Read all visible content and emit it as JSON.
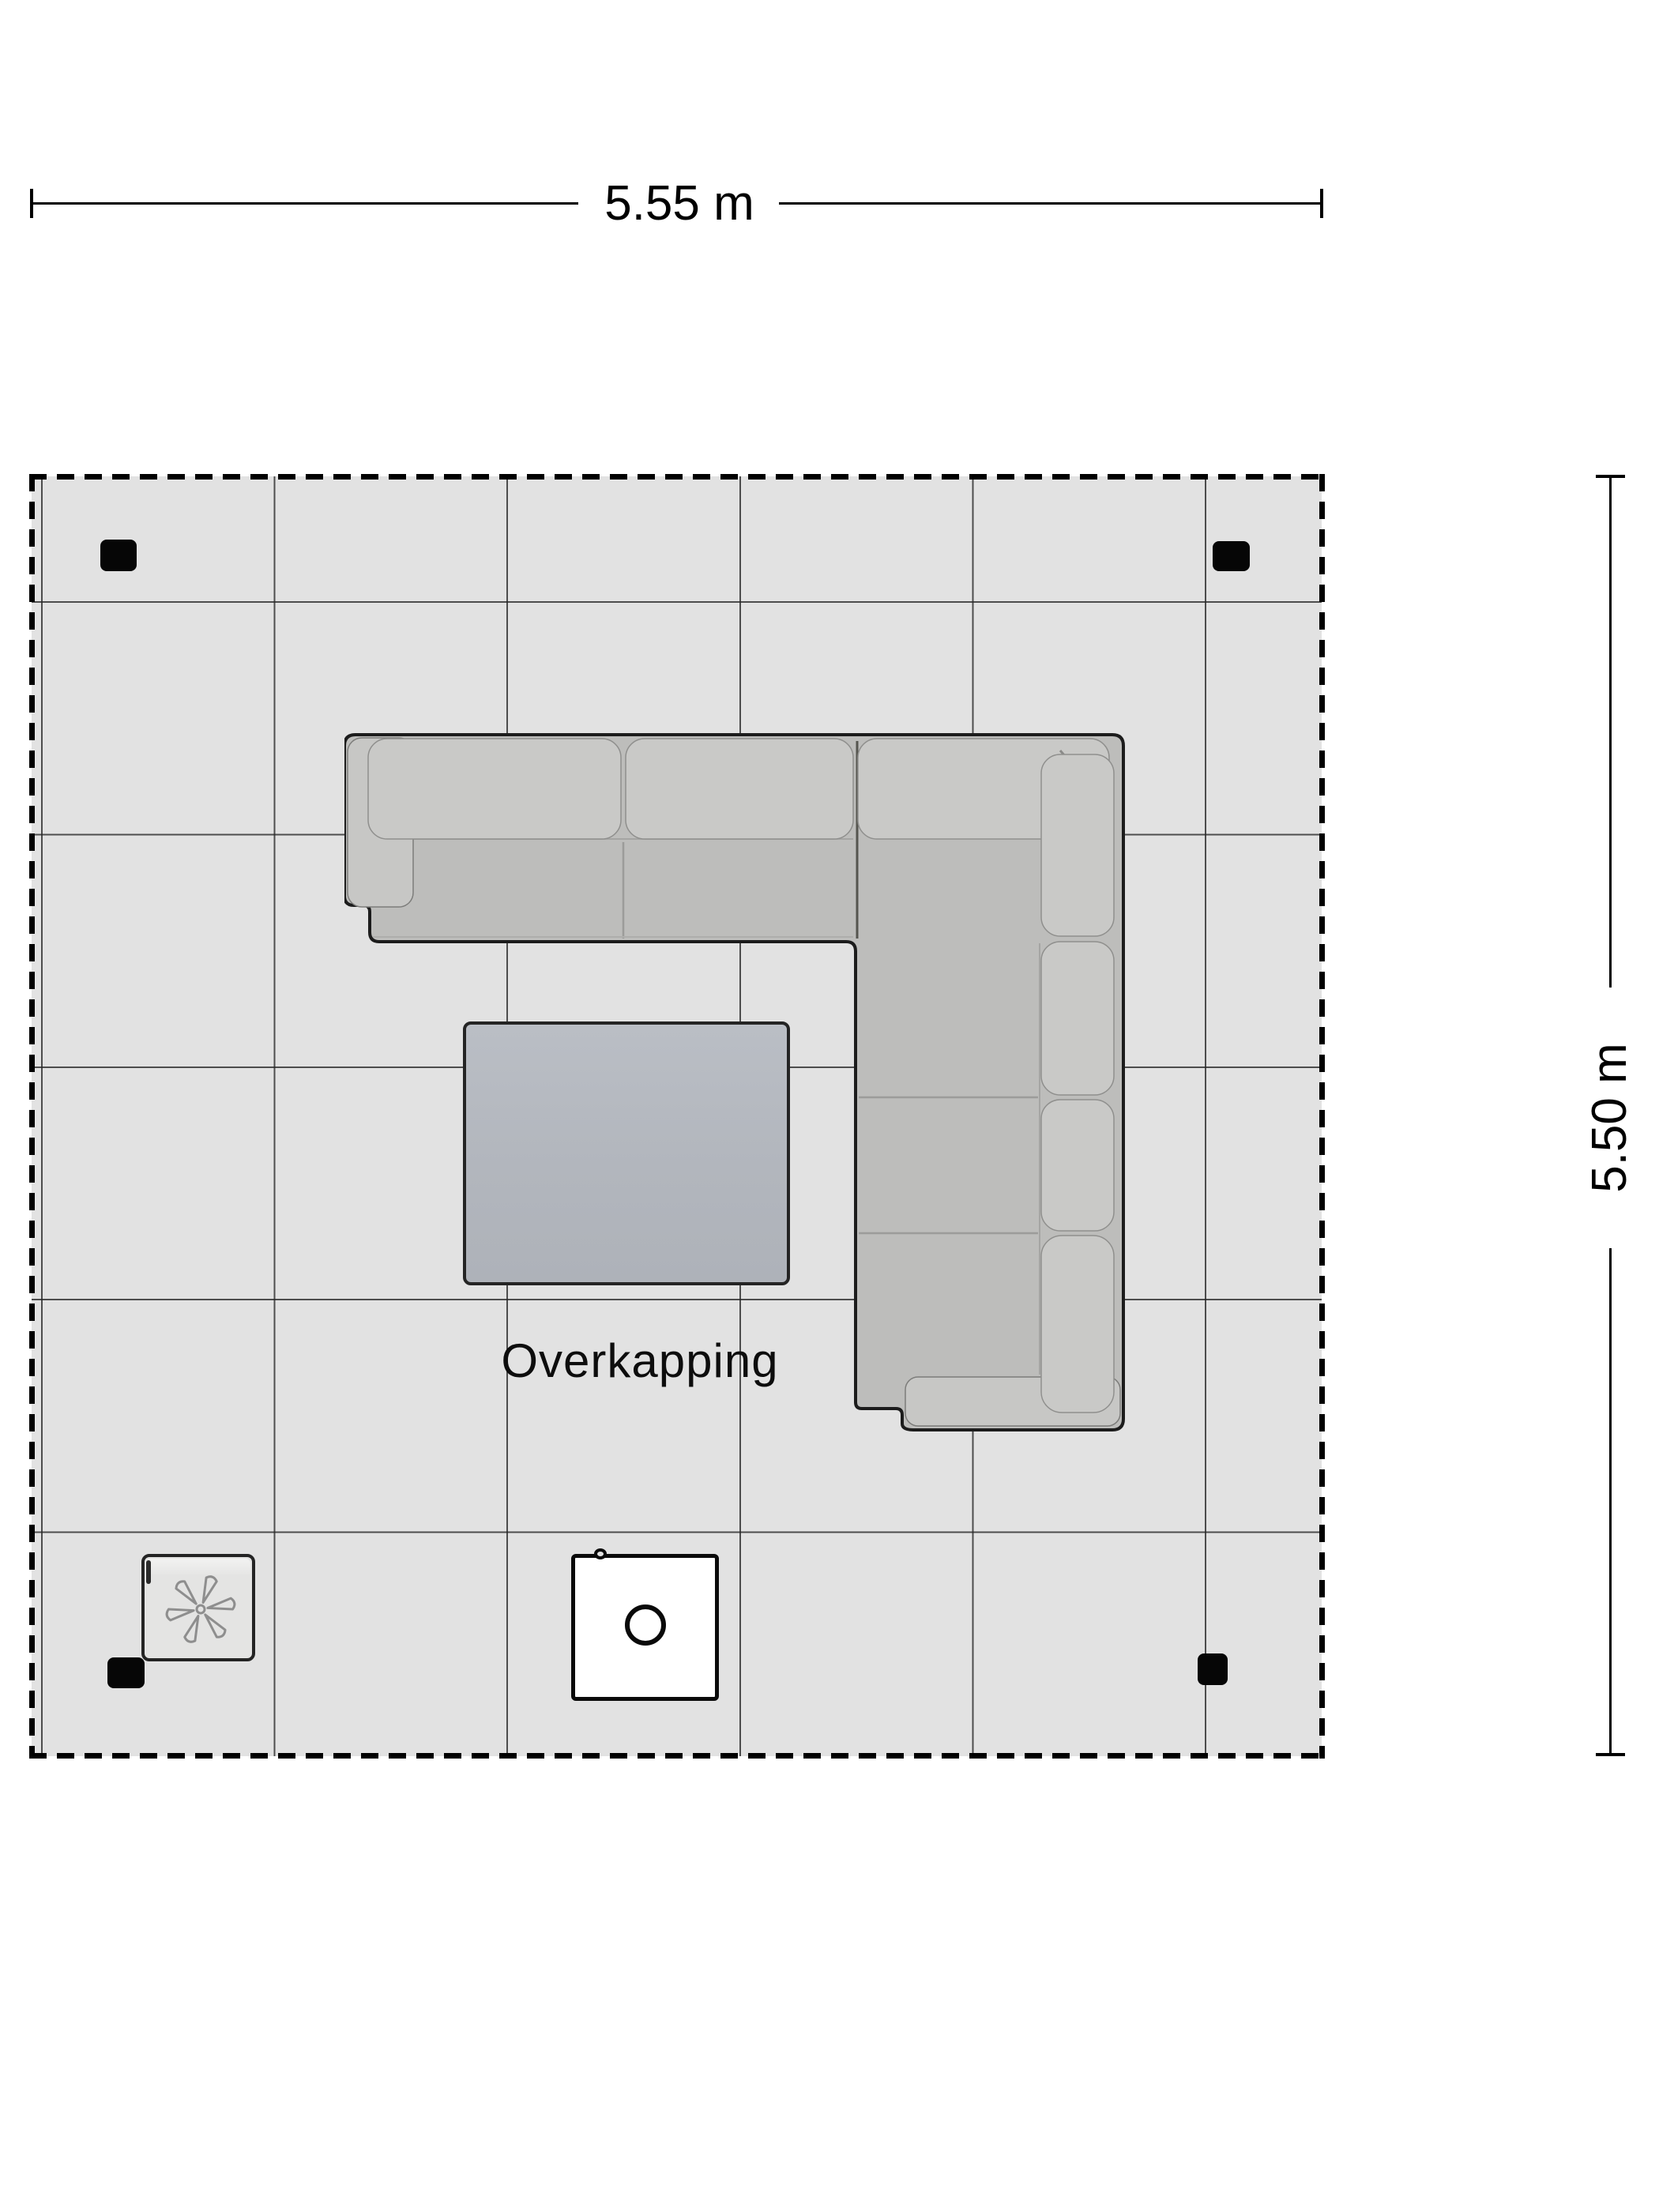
{
  "title": "Overkapping plattegrond",
  "dimensions": {
    "width_label": "5.55 m",
    "height_label": "5.50 m"
  },
  "room": {
    "label": "Overkapping",
    "width_m": 5.55,
    "height_m": 5.5,
    "floor_fill": "#e2e2e2",
    "grid_color": "#282828",
    "dashed_border_color": "#000000"
  },
  "posts": {
    "count": 4,
    "color": "#060606"
  },
  "furniture": {
    "sofa": {
      "kind": "corner-sofa",
      "body_fill": "#bdbdbb",
      "cushion_fill": "#c9c9c7",
      "outline": "#1c1c1c"
    },
    "coffee_table": {
      "kind": "coffee-table",
      "fill": "#b4b8bf",
      "outline": "#242424"
    },
    "fire_table": {
      "kind": "fire-pit-table",
      "fill": "#ffffff",
      "outline": "#0a0a0a"
    },
    "heater": {
      "kind": "patio-heater-fan",
      "fill": "#e4e4e3",
      "outline": "#242424",
      "fan_icon_color": "#8e8e8e"
    }
  }
}
